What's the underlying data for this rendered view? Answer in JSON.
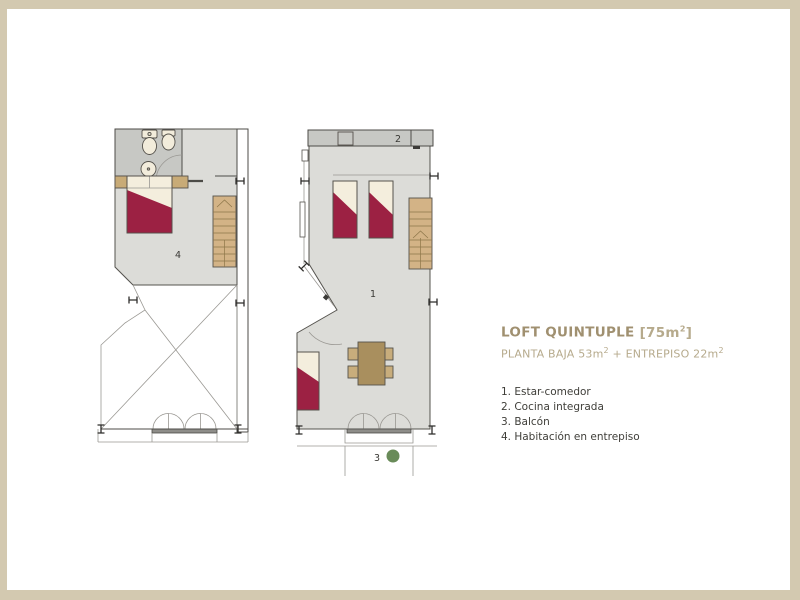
{
  "colors": {
    "frame": "#d3c9b0",
    "floorGray": "#dcdcd8",
    "wetGray": "#c7c8c4",
    "bedRed": "#9c2143",
    "linen": "#f4eedd",
    "stairTan": "#d3b386",
    "wood": "#c8ab77",
    "tableBrown": "#a98f5e",
    "chairTan": "#c8ad7c",
    "plantGreen": "#698b59",
    "titleBrown": "#a09070",
    "titleLight": "#b6aa8c",
    "textDark": "#3f3e39"
  },
  "title": {
    "main": "LOFT QUINTUPLE",
    "area_open": "[75m",
    "area_sup": "2",
    "area_close": "]"
  },
  "subtitle": {
    "p1": "PLANTA BAJA 53m",
    "s1": "2",
    "p2": " + ENTREPISO 22m",
    "s2": "2"
  },
  "legend": {
    "items": [
      "1. Estar-comedor",
      "2. Cocina integrada",
      "3. Balcón",
      "4. Habitación en entrepiso"
    ]
  },
  "plan_labels": {
    "living": "1",
    "kitchen": "2",
    "balcony": "3",
    "bedroom": "4"
  }
}
